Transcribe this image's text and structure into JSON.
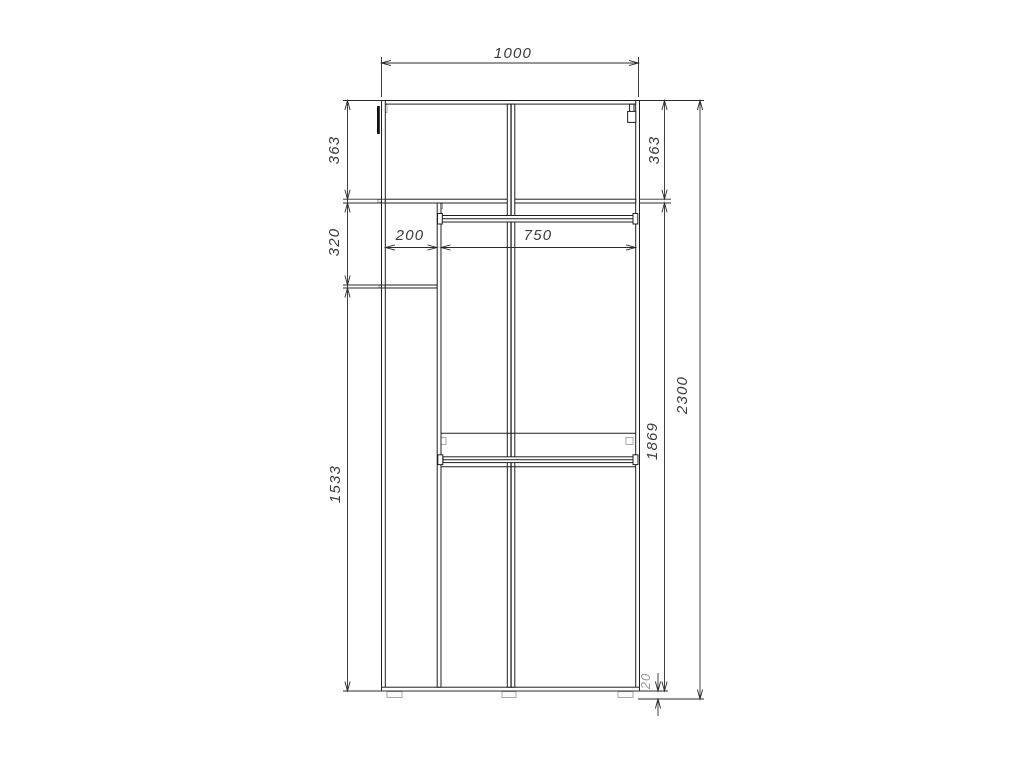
{
  "meta": {
    "type": "furniture technical drawing",
    "subject": "wardrobe front elevation with dimensions"
  },
  "colors": {
    "background": "#ffffff",
    "structure_line": "#1f1f1f",
    "dimension_line": "#2b2b2b",
    "dimension_text": "#3b3b3b",
    "detail_gray": "#a9a9a9",
    "muted_text": "#9a9a9a"
  },
  "dimensions": {
    "overall_width": "1000",
    "top_section_height_left": "363",
    "top_section_height_right": "363",
    "left_niche_height": "320",
    "left_niche_width": "200",
    "hanging_section_width": "750",
    "left_lower_section_height": "1533",
    "interior_height_below_top_shelf": "1869",
    "overall_height": "2300",
    "base_gap_height": "20"
  }
}
